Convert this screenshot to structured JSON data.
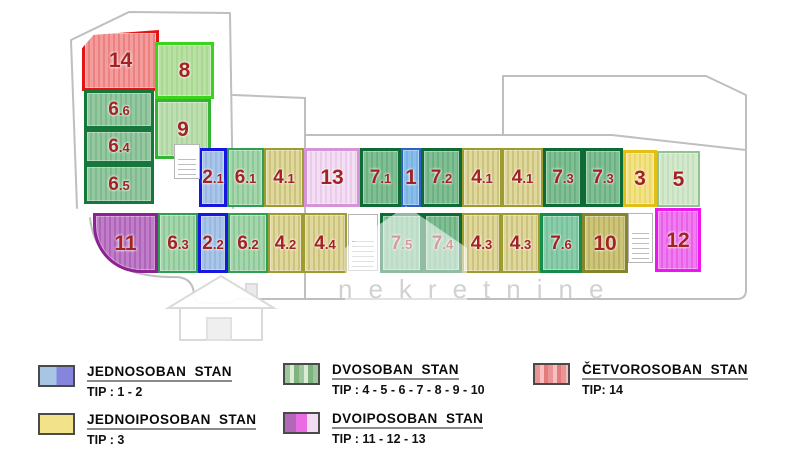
{
  "watermark": {
    "text": "nekretnine"
  },
  "plan": {
    "outline_color": "#bfbfbf",
    "label_color": "#a32222",
    "units": [
      {
        "id": "14",
        "main": "14",
        "sub": "",
        "x": 82,
        "y": 30,
        "w": 77,
        "h": 61,
        "fill": "#f29c9c",
        "stripe": "#ec8181",
        "border": "#e41414",
        "bw": 3,
        "big": true,
        "clip": "polygon(0 30%, 15% 8%, 100% 0%, 100% 100%, 0% 100%)"
      },
      {
        "id": "8",
        "main": "8",
        "sub": "",
        "x": 155,
        "y": 42,
        "w": 59,
        "h": 57,
        "fill": "#bae0a6",
        "stripe": "#a9d893",
        "border": "#3bd41c",
        "bw": 3,
        "big": true
      },
      {
        "id": "6-6",
        "main": "6",
        "sub": ".6",
        "x": 84,
        "y": 90,
        "w": 70,
        "h": 39,
        "fill": "#93c8a0",
        "stripe": "#7fb98d",
        "border": "#17773a",
        "bw": 3
      },
      {
        "id": "6-4",
        "main": "6",
        "sub": ".4",
        "x": 84,
        "y": 129,
        "w": 70,
        "h": 35,
        "fill": "#93c8a0",
        "stripe": "#7fb98d",
        "border": "#17773a",
        "bw": 3
      },
      {
        "id": "6-5",
        "main": "6",
        "sub": ".5",
        "x": 84,
        "y": 164,
        "w": 70,
        "h": 40,
        "fill": "#93c8a0",
        "stripe": "#7fb98d",
        "border": "#17773a",
        "bw": 3
      },
      {
        "id": "9",
        "main": "9",
        "sub": "",
        "x": 155,
        "y": 99,
        "w": 56,
        "h": 60,
        "fill": "#bedfb2",
        "stripe": "#aed5a0",
        "border": "#35b335",
        "bw": 3,
        "big": true
      },
      {
        "id": "2-1",
        "main": "2",
        "sub": ".1",
        "x": 199,
        "y": 148,
        "w": 28,
        "h": 59,
        "fill": "#a9c6e9",
        "stripe": "#98b8e2",
        "border": "#1717e0",
        "bw": 3
      },
      {
        "id": "6-1",
        "main": "6",
        "sub": ".1",
        "x": 227,
        "y": 148,
        "w": 37,
        "h": 59,
        "fill": "#a5d6ad",
        "stripe": "#8fc898",
        "border": "#2f9e52",
        "bw": 2
      },
      {
        "id": "4-1-a",
        "main": "4",
        "sub": ".1",
        "x": 264,
        "y": 148,
        "w": 40,
        "h": 59,
        "fill": "#ded89d",
        "stripe": "#cec27f",
        "border": "#9c9c30",
        "bw": 2
      },
      {
        "id": "13",
        "main": "13",
        "sub": "",
        "x": 304,
        "y": 148,
        "w": 56,
        "h": 59,
        "fill": "#f3def3",
        "stripe": "#e9cce9",
        "border": "#d793d7",
        "bw": 3,
        "big": true
      },
      {
        "id": "7-1",
        "main": "7",
        "sub": ".1",
        "x": 360,
        "y": 148,
        "w": 41,
        "h": 59,
        "fill": "#7fbf93",
        "stripe": "#6db183",
        "border": "#0e6b36",
        "bw": 3
      },
      {
        "id": "1",
        "main": "1",
        "sub": "",
        "x": 401,
        "y": 148,
        "w": 20,
        "h": 59,
        "fill": "#8abee9",
        "stripe": "#79b3e3",
        "border": "#2e62c8",
        "bw": 2,
        "big": true
      },
      {
        "id": "7-2",
        "main": "7",
        "sub": ".2",
        "x": 421,
        "y": 148,
        "w": 41,
        "h": 59,
        "fill": "#7fbf93",
        "stripe": "#6db183",
        "border": "#0e6b36",
        "bw": 3
      },
      {
        "id": "4-1-b",
        "main": "4",
        "sub": ".1",
        "x": 462,
        "y": 148,
        "w": 40,
        "h": 59,
        "fill": "#ded89d",
        "stripe": "#cec27f",
        "border": "#9c9c30",
        "bw": 2
      },
      {
        "id": "4-1-c",
        "main": "4",
        "sub": ".1",
        "x": 502,
        "y": 148,
        "w": 41,
        "h": 59,
        "fill": "#ded89d",
        "stripe": "#cec27f",
        "border": "#9c9c30",
        "bw": 2
      },
      {
        "id": "7-3-a",
        "main": "7",
        "sub": ".3",
        "x": 543,
        "y": 148,
        "w": 40,
        "h": 59,
        "fill": "#7fbf93",
        "stripe": "#6db183",
        "border": "#0e6b36",
        "bw": 3
      },
      {
        "id": "7-3-b",
        "main": "7",
        "sub": ".3",
        "x": 583,
        "y": 148,
        "w": 40,
        "h": 59,
        "fill": "#7fbf93",
        "stripe": "#6db183",
        "border": "#0e6b36",
        "bw": 3
      },
      {
        "id": "3",
        "main": "3",
        "sub": "",
        "x": 623,
        "y": 150,
        "w": 34,
        "h": 57,
        "fill": "#f3e388",
        "stripe": "#ecd76a",
        "border": "#e2be16",
        "bw": 3,
        "big": true
      },
      {
        "id": "5",
        "main": "5",
        "sub": "",
        "x": 657,
        "y": 151,
        "w": 43,
        "h": 56,
        "fill": "#d3e8cd",
        "stripe": "#c5e0bd",
        "border": "#90c292",
        "bw": 2,
        "big": true
      },
      {
        "id": "11",
        "main": "11",
        "sub": "",
        "x": 93,
        "y": 213,
        "w": 65,
        "h": 60,
        "fill": "#c07ec8",
        "stripe": "#ae64b8",
        "border": "#8b2492",
        "bw": 3,
        "big": true,
        "radius": "0 0 0 48px"
      },
      {
        "id": "6-3",
        "main": "6",
        "sub": ".3",
        "x": 158,
        "y": 213,
        "w": 40,
        "h": 60,
        "fill": "#a5d6ad",
        "stripe": "#8fc898",
        "border": "#2f9e52",
        "bw": 2
      },
      {
        "id": "2-2",
        "main": "2",
        "sub": ".2",
        "x": 198,
        "y": 213,
        "w": 30,
        "h": 60,
        "fill": "#a9c6e9",
        "stripe": "#98b8e2",
        "border": "#1717e0",
        "bw": 3
      },
      {
        "id": "6-2",
        "main": "6",
        "sub": ".2",
        "x": 228,
        "y": 213,
        "w": 40,
        "h": 60,
        "fill": "#a5d6ad",
        "stripe": "#8fc898",
        "border": "#2f9e52",
        "bw": 2
      },
      {
        "id": "4-2",
        "main": "4",
        "sub": ".2",
        "x": 268,
        "y": 213,
        "w": 35,
        "h": 60,
        "fill": "#ded89d",
        "stripe": "#cec27f",
        "border": "#9c9c30",
        "bw": 2
      },
      {
        "id": "4-4",
        "main": "4",
        "sub": ".4",
        "x": 303,
        "y": 213,
        "w": 44,
        "h": 60,
        "fill": "#ded89d",
        "stripe": "#cec27f",
        "border": "#9c9c30",
        "bw": 2
      },
      {
        "id": "7-5",
        "main": "7",
        "sub": ".5",
        "x": 380,
        "y": 213,
        "w": 43,
        "h": 60,
        "fill": "#7fbf93",
        "stripe": "#6db183",
        "border": "#0e6b36",
        "bw": 3
      },
      {
        "id": "7-4",
        "main": "7",
        "sub": ".4",
        "x": 423,
        "y": 213,
        "w": 39,
        "h": 60,
        "fill": "#7fbf93",
        "stripe": "#6db183",
        "border": "#0e6b36",
        "bw": 3
      },
      {
        "id": "4-3-a",
        "main": "4",
        "sub": ".3",
        "x": 462,
        "y": 213,
        "w": 39,
        "h": 60,
        "fill": "#ded89d",
        "stripe": "#cec27f",
        "border": "#9c9c30",
        "bw": 2
      },
      {
        "id": "4-3-b",
        "main": "4",
        "sub": ".3",
        "x": 501,
        "y": 213,
        "w": 39,
        "h": 60,
        "fill": "#ded89d",
        "stripe": "#cec27f",
        "border": "#9c9c30",
        "bw": 2
      },
      {
        "id": "7-6",
        "main": "7",
        "sub": ".6",
        "x": 540,
        "y": 213,
        "w": 42,
        "h": 60,
        "fill": "#8bccaa",
        "stripe": "#77c29a",
        "border": "#148c4c",
        "bw": 3
      },
      {
        "id": "10",
        "main": "10",
        "sub": "",
        "x": 582,
        "y": 213,
        "w": 46,
        "h": 60,
        "fill": "#cdc57b",
        "stripe": "#bdb364",
        "border": "#85852c",
        "bw": 3,
        "big": true
      },
      {
        "id": "12",
        "main": "12",
        "sub": "",
        "x": 655,
        "y": 208,
        "w": 46,
        "h": 64,
        "fill": "#f07df0",
        "stripe": "#e760e7",
        "border": "#ee16ee",
        "bw": 3,
        "big": true
      }
    ],
    "grey_areas": [
      {
        "x": 174,
        "y": 144,
        "w": 26,
        "h": 35
      },
      {
        "x": 348,
        "y": 214,
        "w": 30,
        "h": 57
      },
      {
        "x": 628,
        "y": 213,
        "w": 25,
        "h": 50
      }
    ]
  },
  "legend": {
    "items": [
      {
        "x": 38,
        "y": 363,
        "title": "JEDNOSOBAN  STAN",
        "tip": "TIP : 1 - 2",
        "bg": "linear-gradient(90deg,#a6c6e4 0 50%,#8585dd 50% 100%)"
      },
      {
        "x": 38,
        "y": 411,
        "title": "JEDNOIPOSOBAN  STAN",
        "tip": "TIP : 3",
        "bg": "#f2e28a"
      },
      {
        "x": 283,
        "y": 361,
        "title": "DVOSOBAN  STAN",
        "tip": "TIP : 4 - 5 - 6 - 7 - 8 - 9 - 10",
        "bg": "repeating-linear-gradient(90deg,#9cc79c 0 5px,#dcecd4 5px 9px,#7fb27f 9px 14px)"
      },
      {
        "x": 283,
        "y": 410,
        "title": "DVOIPOSOBAN  STAN",
        "tip": "TIP : 11 - 12 - 13",
        "bg": "linear-gradient(90deg,#b168b8 0 33%,#ea6ce2 33% 66%,#f2dcf2 66% 100%)"
      },
      {
        "x": 533,
        "y": 361,
        "title": "ČETVOROSOBAN  STAN",
        "tip": "TIP: 14",
        "bg": "repeating-linear-gradient(90deg,#ea9494 0 5px,#f6c0c0 5px 9px,#e27b7b 9px 13px)"
      }
    ]
  }
}
